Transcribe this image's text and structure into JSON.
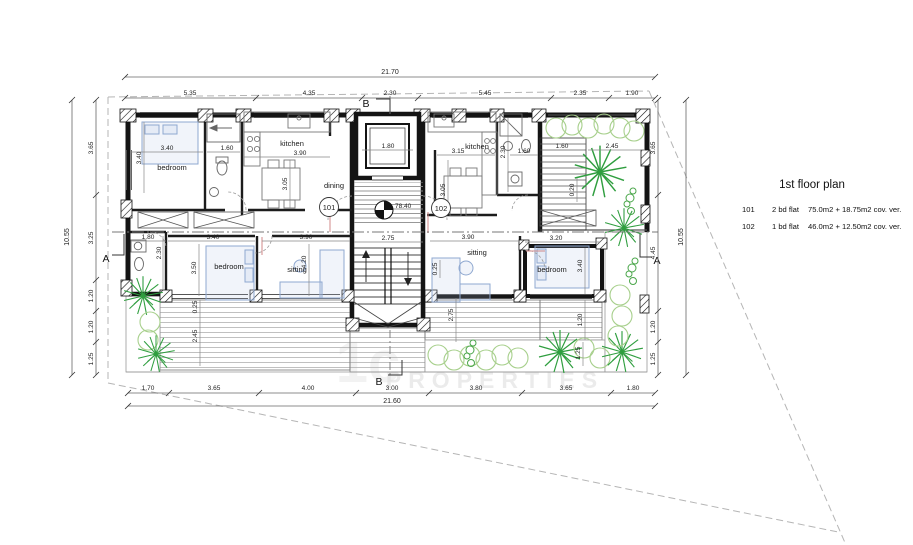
{
  "drawing": {
    "title": "1st floor plan",
    "legend": [
      {
        "no": "101",
        "type": "2 bd flat",
        "area": "75.0m2 + 18.75m2 cov. ver."
      },
      {
        "no": "102",
        "type": "1 bd flat",
        "area": "46.0m2 + 12.50m2 cov. ver."
      }
    ]
  },
  "watermark": {
    "logo": "1c",
    "name": "PROPERTIES"
  },
  "sections": {
    "a": "A",
    "b": "B"
  },
  "tags": {
    "f101": "101",
    "f102": "102"
  },
  "rooms": {
    "bedroom": "bedroom",
    "kitchen": "kitchen",
    "dining": "dining",
    "sitting": "sitting"
  },
  "levels": {
    "landing": "78.40"
  },
  "dims": {
    "top_total": "21.70",
    "top": [
      "5.35",
      "4.35",
      "2.30",
      "5.45",
      "2.35",
      "1.90"
    ],
    "bottom_total": "21.60",
    "bottom": [
      "1.70",
      "3.65",
      "4.00",
      "3.00",
      "3.80",
      "3.65",
      "1.80"
    ],
    "left_total": "10.55",
    "left": [
      "3.65",
      "3.25",
      "1.20",
      "1.20",
      "1.25"
    ],
    "right_total": "10.55",
    "right": [
      "3.65",
      "4.45",
      "1.20",
      "1.25"
    ],
    "interior": {
      "bed101_w": "3.40",
      "bed101_h": "3.40",
      "bath101_w": "1.60",
      "kitchen101_w": "3.90",
      "dining101_h": "3.05",
      "wc101_w": "1.80",
      "wc101_h": "2.30",
      "bed101b_w": "3.40",
      "bed101b_h": "3.50",
      "sitting101_w": "3.90",
      "sitting101_h": "4.20",
      "stair_w": "2.75",
      "lift_w": "1.80",
      "kitchen102_w": "3.15",
      "kitchen102_h": "3.05",
      "bath102_w": "1.60",
      "bath102_h": "2.30",
      "extstair_w": "1.60",
      "extstair_off": "0.20",
      "terrace_w": "2.45",
      "sitting102_w": "3.90",
      "deck102_h": "2.75",
      "deck102_off": "0.25",
      "bed102_w": "3.20",
      "bed102_h": "3.40",
      "deck102r_a": "1.20",
      "deck102r_b": "1.25",
      "deck101_off": "0.25",
      "deck101_h": "2.45"
    }
  },
  "colors": {
    "wall": "#141414",
    "furniture_blue": "#8fa8d0",
    "plant_dark": "#2f9e3f",
    "plant_light": "#a8d08d",
    "dimension": "#333333",
    "boundary_dash": "#b5b5b5"
  }
}
